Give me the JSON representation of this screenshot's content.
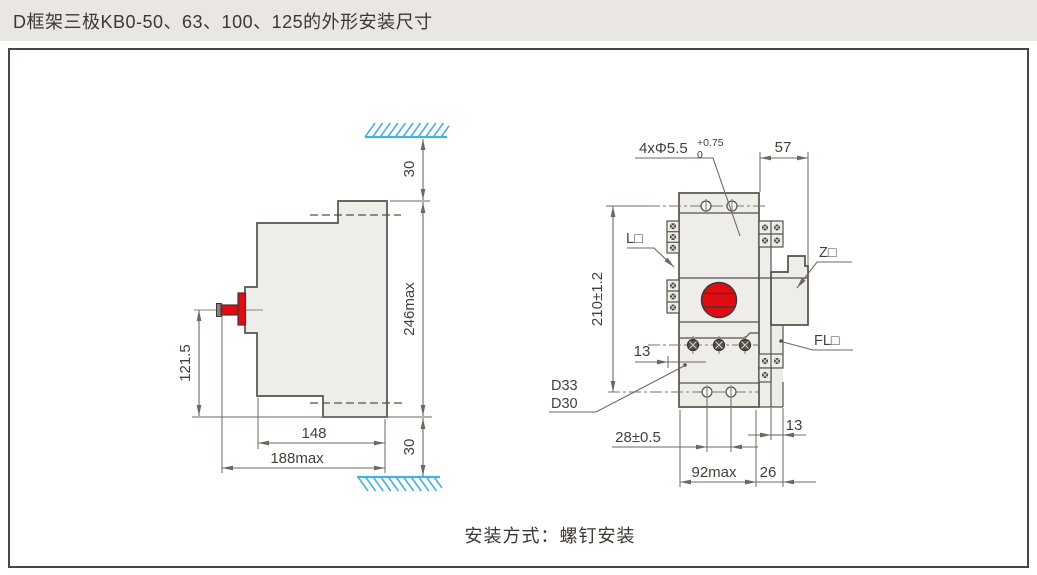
{
  "title": "D框架三极KB0-50、63、100、125的外形安装尺寸",
  "caption": "安装方式：螺钉安装",
  "side": {
    "dim_top_clearance": "30",
    "dim_height_max": "246max",
    "dim_handle_height": "121.5",
    "dim_depth": "148",
    "dim_depth_max": "188max",
    "dim_bottom_clearance": "30"
  },
  "front": {
    "holes_label": "4xΦ5.5",
    "holes_tol_upper": "+0.75",
    "holes_tol_lower": "0",
    "dim_top_width": "57",
    "dim_mount_height": "210±1.2",
    "dim_terminal_depth": "13",
    "label_l": "L□",
    "label_z": "Z□",
    "label_fl": "FL□",
    "model_line1": "D33",
    "model_line2": "D30",
    "dim_hole_spacing": "28±0.5",
    "dim_width_max": "92max",
    "dim_side": "26",
    "dim_side_gap": "13"
  },
  "colors": {
    "accent_red": "#df0c12",
    "hatch_blue": "#46b1e1",
    "line": "#6f6860",
    "body_fill": "#efedea",
    "titlebar_bg": "#eae7e2"
  }
}
